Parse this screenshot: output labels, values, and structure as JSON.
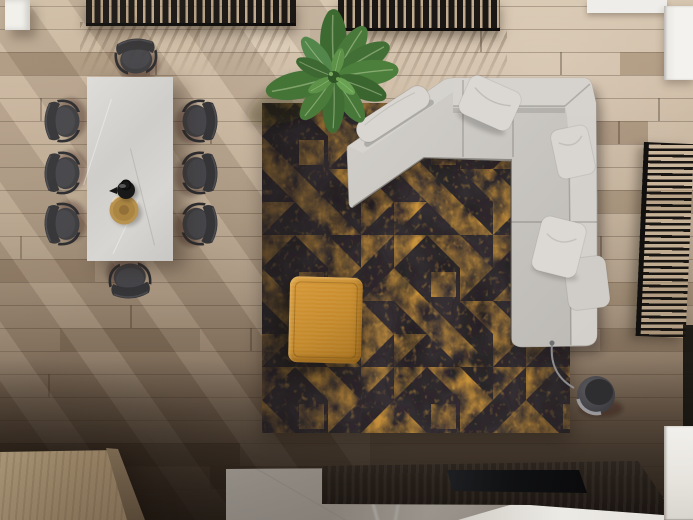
{
  "scene": {
    "title": "Top-down 3D render of an open-plan living and dining room",
    "items": {
      "dining_table": {
        "label": "rectangular marble dining table",
        "chairs": 8
      },
      "tabletop": {
        "teapot": "black teapot",
        "bowl": "round wooden bowl"
      },
      "plant": {
        "label": "large banana-leaf potted plant",
        "leaves": 11
      },
      "rug": {
        "label": "distressed area rug",
        "pattern": "gold half-square triangles on charcoal"
      },
      "ottoman": {
        "label": "mustard fabric ottoman"
      },
      "sofa": {
        "label": "light gray L-shaped sectional sofa with angled chaise",
        "pillows": 4,
        "bolster": 1
      },
      "floor_lamp": {
        "label": "arched floor lamp with gray drum shade"
      },
      "louver_screen": {
        "label": "dark slatted screen at right edge"
      },
      "media_console": {
        "label": "dark wood low media console",
        "device": "flat black panel"
      },
      "stone_slab": {
        "label": "gray stone platform"
      },
      "wood_block": {
        "label": "light wood block table, bottom-left"
      },
      "white_cabinet": {
        "label": "white cabinet, bottom-right"
      },
      "ceiling_slats": {
        "label": "dark slatted strips along top edge",
        "count": 2
      },
      "white_beams": {
        "label": "white beams/blocks at top corners"
      }
    }
  },
  "palette": {
    "floor_light": "#cdbaa1",
    "floor_mid": "#a3907a",
    "floor_dark": "#42382f",
    "rug_base": "#352f33",
    "rug_dark": "#211c1f",
    "rug_gold": "#c8913a",
    "rug_gold_bright": "#d9a246",
    "ottoman": "#c4892b",
    "ottoman_light": "#d89a39",
    "sofa": "#c6c3be",
    "sofa_light": "#d7d4cf",
    "table": "#d8d6d2",
    "chair": "#3d3d40",
    "plant_green": "#44743a",
    "plant_dark": "#2f5526",
    "wood_block": "#ac9573",
    "stone_slab": "#938d85",
    "console": "#241d17",
    "tv": "#101113",
    "cabinet": "#f2f0ec",
    "lamp_shade": "#46464a",
    "slat_dark": "#1b1714",
    "louver_dark": "#171412",
    "bowl": "#b8914e",
    "teapot": "#161616"
  }
}
